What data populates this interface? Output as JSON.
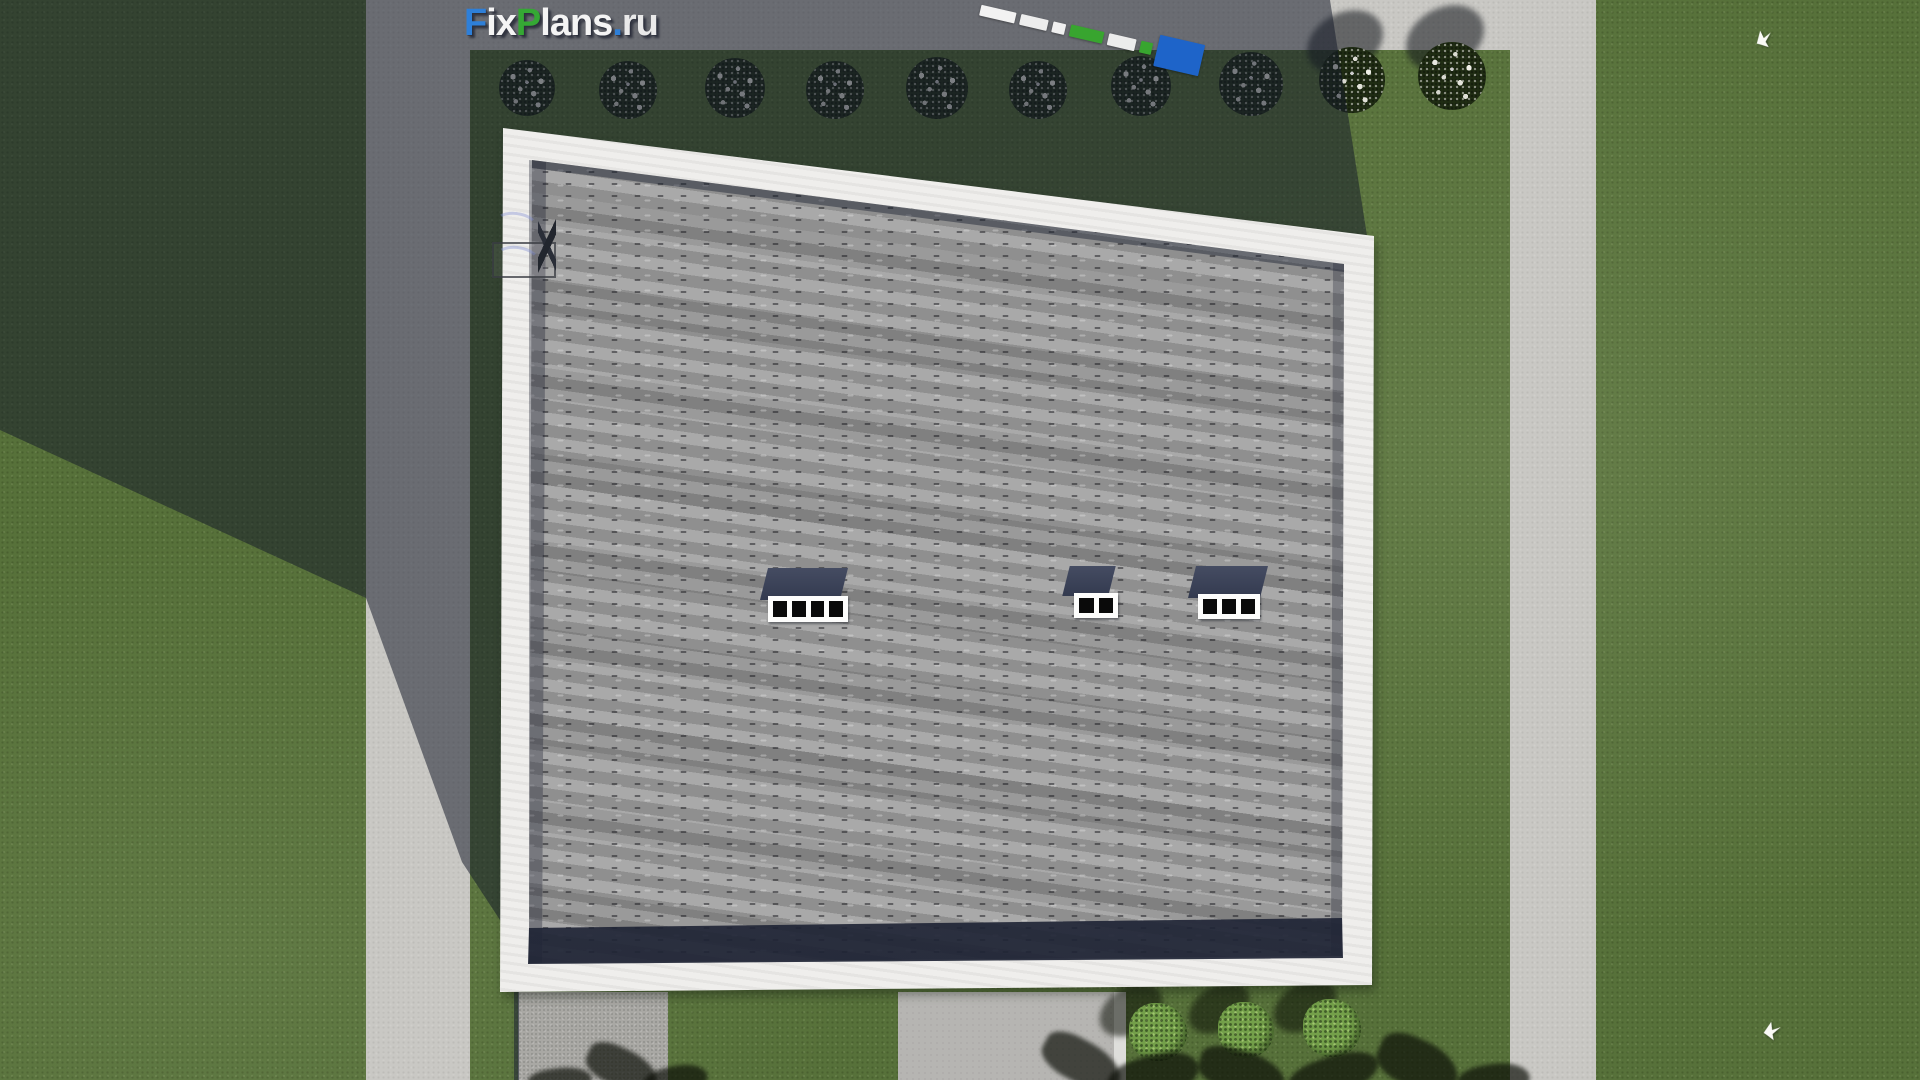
{
  "watermark": {
    "text": "FixPlans.ru",
    "parts": [
      {
        "text": "F",
        "color": "#2e7fd8",
        "css": "color:#2e7fd8"
      },
      {
        "text": "ix",
        "color": "#f4f4f4",
        "css": "color:#f4f4f4"
      },
      {
        "text": "P",
        "color": "#35a834",
        "css": "color:#35a834"
      },
      {
        "text": "lans",
        "color": "#f4f4f4",
        "css": "color:#f4f4f4"
      },
      {
        "text": ".",
        "color": "#2e7fd8",
        "css": "color:#2e7fd8"
      },
      {
        "text": "ru",
        "color": "#e9e9e9",
        "css": "color:#e9e9e9"
      }
    ]
  },
  "scene": {
    "description": "Aerial top-down 3D render of a house roof with grey shingles and white fascia, surrounded by lawn, concrete paths, flowering bushes, green shrubs and two white birds; large diagonal building shadow over the upper-left area",
    "roof": {
      "skylights": [
        {
          "panes": 4
        },
        {
          "panes": 2
        },
        {
          "panes": 3
        }
      ]
    },
    "vegetation": {
      "shadow_flower_bushes": 8,
      "sunlit_flower_bushes": 2,
      "green_bushes": 3
    },
    "birds": 2,
    "marker_segments": [
      {
        "color": "#f2f2f2",
        "css": "width:36px;height:11px;background:#f2f2f2"
      },
      {
        "color": "#ededed",
        "css": "width:28px;height:11px;background:#ededed"
      },
      {
        "color": "#f0f0f0",
        "css": "width:13px;height:11px;background:#f0f0f0"
      },
      {
        "color": "#38a52f",
        "css": "width:34px;height:12px;background:#38a52f"
      },
      {
        "color": "#ececec",
        "css": "width:28px;height:12px;background:#ececec"
      },
      {
        "color": "#38a52f",
        "css": "width:12px;height:12px;background:#38a52f"
      },
      {
        "color": "#1e64c9",
        "css": "width:46px;height:32px;background:#1e64c9"
      }
    ],
    "palette": {
      "grass_lit": "#57713a",
      "grass_shadow": "#344331",
      "path_lit": "#c9c8c4",
      "path_shadow": "#696c72",
      "roof_shingle": "#9f9f9f",
      "roof_fascia": "#efeeec",
      "roof_eave_shadow": "#2a3040",
      "skylight_frame": "#fdfdfc",
      "skylight_pane": "#0a0a0a"
    }
  }
}
